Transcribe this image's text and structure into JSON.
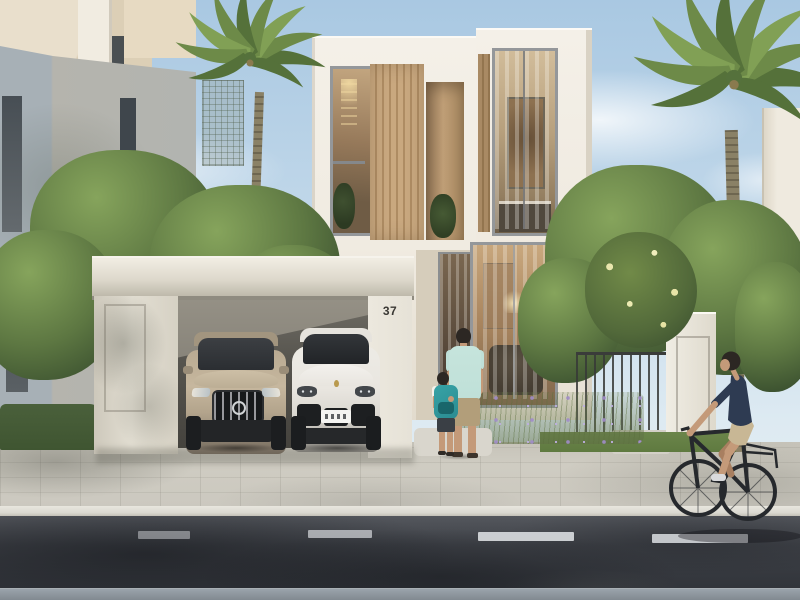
{
  "meta": {
    "kind": "photorealistic architectural exterior render",
    "description": "Modern two-storey white villa number 37 with wood-slat screens, carport with two parked SUVs, father and child walking to the entrance, landscaped garden with palms, and a cyclist passing on the street."
  },
  "villa": {
    "house_number": "37"
  },
  "scene": {
    "sky": "clear light-blue sky with soft clouds",
    "buildings": [
      "grey neighbouring villa (left)",
      "cream building behind (top-left)",
      "main white villa with timber slats (centre)",
      "white building (far right)"
    ],
    "vehicles": [
      "champagne luxury SUV with chrome grille",
      "white sports SUV with illegible licence plate"
    ],
    "people": [
      "man in mint t-shirt and khaki shorts holding hands with child wearing teal backpack",
      "cyclist in navy polo and beige shorts on dark city bike"
    ],
    "vegetation": [
      "two date palms",
      "leafy green trees",
      "lavender flower bed",
      "yellow flowering shrub",
      "clipped hedge"
    ],
    "street": [
      "paver sidewalk and driveway",
      "kerb",
      "asphalt road with white dashed lane marking",
      "dappled tree shadows"
    ]
  },
  "colors": {
    "sky_top": "#a9c8e2",
    "sky_horizon": "#ddeaf2",
    "cloud": "#f2f7fa",
    "cream_facade": "#e9dfcc",
    "grey_facade": "#b2b4b0",
    "white_facade": "#f4f0e8",
    "facade_shadow": "#d9d2c4",
    "wood_slat": "#c9a87f",
    "wood_slat_dark": "#ae8c63",
    "glass_warm": "#c0a47f",
    "glass_cool": "#3c4349",
    "interior_wood": "#8d7150",
    "canopy": "#ddd8cb",
    "pillar": "#e6e2d7",
    "carport_shade": "#55534d",
    "number_ink": "#3a3834",
    "mercedes_body": "#b3a48c",
    "porsche_body": "#e9e6e0",
    "car_glass": "#2b2e32",
    "car_trim": "#232527",
    "tree_mid": "#5d7742",
    "tree_dark": "#3c5230",
    "tree_light": "#86a45c",
    "palm_frond": "#6d8a48",
    "palm_trunk": "#8a8166",
    "hedge": "#3f5531",
    "grass": "#5f7a40",
    "lavender": "#978bbd",
    "yellow_bloom": "#e9e6ad",
    "sidewalk": "#cfccc2",
    "curb": "#dbd9d1",
    "road": "#3e4147",
    "road_shadow": "#1a1c21",
    "lane_marking": "#d3d6d9",
    "far_curb": "#9aa3ab",
    "skin": "#c49a79",
    "hair": "#2c2723",
    "shirt_mint": "#bfe0d8",
    "shorts_khaki": "#b29e7a",
    "backpack_teal": "#2a8b91",
    "shirt_navy": "#2e3b52",
    "shorts_beige": "#c8b795",
    "bike_frame": "#26292d",
    "gate_metal": "#3a3c3a"
  }
}
